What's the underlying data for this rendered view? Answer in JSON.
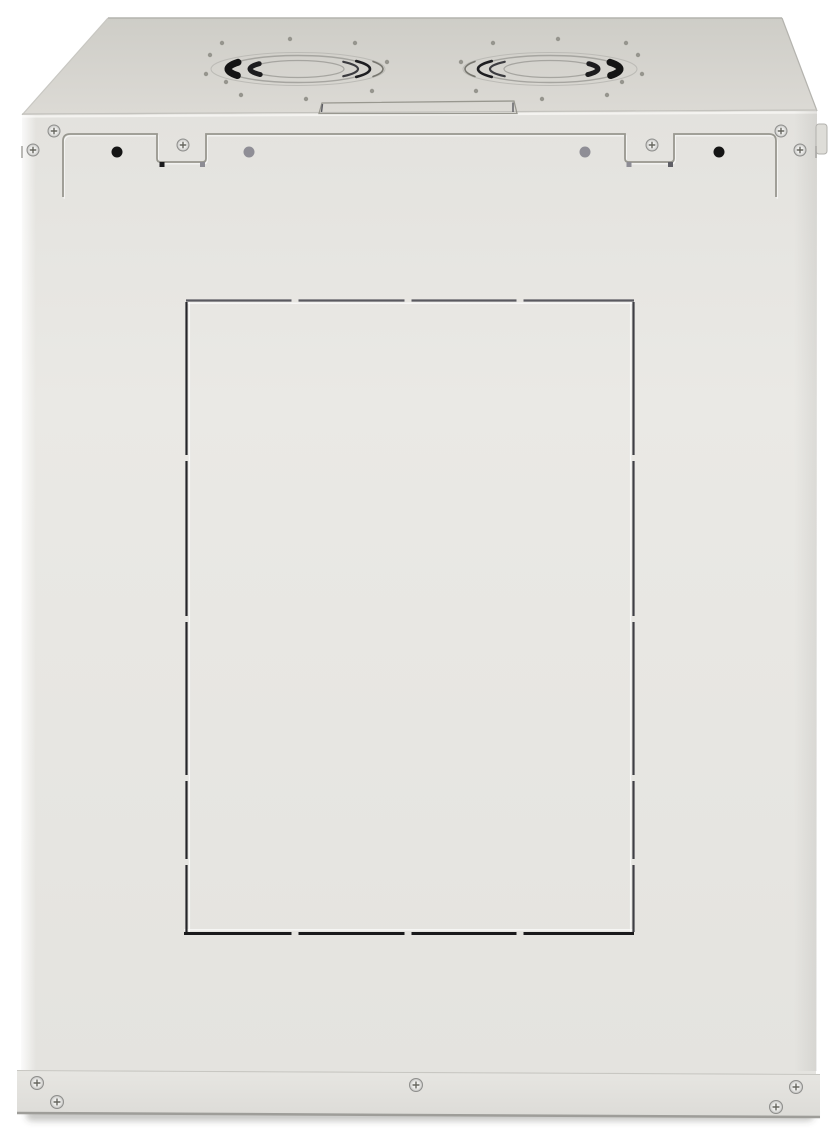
{
  "colors": {
    "background": "#ffffff",
    "top_face_back": "#cecdc7",
    "top_face_front": "#dcdad5",
    "front_face_top": "#e3e2de",
    "front_face_mid": "#eae9e5",
    "front_face_bottom": "#e4e3df",
    "flange_top": "#e7e6e2",
    "flange_bottom": "#dcdbd7",
    "flange_edge": "#9e9d99",
    "edge_line": "#b4b3ae",
    "edge_light": "#c8c7c2",
    "fold_dark": "#c3c2bd",
    "fold_highlight": "#f6f5f2",
    "outline_groove": "#98978f",
    "seam": "#a9a8a4",
    "hole_black": "#151515",
    "hole_gray": "#8f8e96",
    "square_dark": "#1a1a1c",
    "square_gray": "#8d8c94",
    "screw_edge": "#8e8e8c",
    "screw_slot": "#66665f",
    "fan_line": "#a6a5a0",
    "fan_line_light": "#bcbbb6",
    "fan_dark": "#141414",
    "fan_mid": "#3c3c40"
  },
  "layers": [
    {
      "tag": "rect",
      "name": "floor-shadow",
      "attrs": {
        "x": 26,
        "y": 1108,
        "width": 788,
        "height": 13,
        "rx": 6,
        "fill": "rgba(70,70,66,0.30)",
        "filter": "url(#soft)"
      }
    },
    {
      "tag": "polygon",
      "name": "top-panel-face",
      "attrs": {
        "points": "108,18 782,18 817,111 22,115",
        "fill": "url(#gTop)"
      }
    },
    {
      "tag": "polygon",
      "name": "back-panel-face",
      "attrs": {
        "points": "22,115 817,111 816,1074 21,1070",
        "fill": "url(#gFront)"
      }
    },
    {
      "tag": "polygon",
      "name": "bottom-flange",
      "attrs": {
        "points": "17,1070 820,1074 820,1118 17,1114",
        "fill": "url(#gFlange)"
      }
    },
    {
      "tag": "line",
      "name": "top-back-edge",
      "attrs": {
        "x1": 108,
        "y1": 18,
        "x2": 782,
        "y2": 18,
        "stroke": "var(--edge-line)",
        "stroke-width": 1.6
      }
    },
    {
      "tag": "line",
      "name": "top-left-edge",
      "attrs": {
        "x1": 108,
        "y1": 18,
        "x2": 22,
        "y2": 115,
        "stroke": "var(--edge-light)",
        "stroke-width": 1.2
      }
    },
    {
      "tag": "line",
      "name": "top-right-edge",
      "attrs": {
        "x1": 782,
        "y1": 18,
        "x2": 817,
        "y2": 111,
        "stroke": "var(--edge-line)",
        "stroke-width": 1.2
      }
    },
    {
      "tag": "line",
      "name": "top-fold-shade",
      "attrs": {
        "x1": 22,
        "y1": 114,
        "x2": 817,
        "y2": 110,
        "stroke": "var(--fold-dark)",
        "stroke-width": 1.2
      }
    },
    {
      "tag": "line",
      "name": "top-fold-highlight",
      "attrs": {
        "x1": 22,
        "y1": 116.5,
        "x2": 817,
        "y2": 112.5,
        "stroke": "var(--fold-highlight)",
        "stroke-width": 2.2,
        "opacity": 0.9
      }
    },
    {
      "tag": "rect",
      "name": "left-edge-highlight",
      "attrs": {
        "x": 21,
        "y": 115,
        "width": 15,
        "height": 956,
        "fill": "url(#gLeft)"
      }
    },
    {
      "tag": "rect",
      "name": "right-edge-shade",
      "attrs": {
        "x": 794,
        "y": 111,
        "width": 23,
        "height": 960,
        "fill": "url(#gRight)"
      }
    },
    {
      "tag": "rect",
      "name": "hinge-nub",
      "attrs": {
        "x": 816,
        "y": 124,
        "width": 11,
        "height": 30,
        "rx": 3,
        "fill": "#deddd8",
        "stroke": "#b2b1ad",
        "stroke-width": 1
      }
    },
    {
      "tag": "line",
      "name": "left-edge-seam",
      "attrs": {
        "x1": 22,
        "y1": 146,
        "x2": 22,
        "y2": 158,
        "stroke": "var(--seam)",
        "stroke-width": 1.6
      }
    },
    {
      "tag": "line",
      "name": "right-edge-seam",
      "attrs": {
        "x1": 816,
        "y1": 146,
        "x2": 816,
        "y2": 158,
        "stroke": "var(--seam)",
        "stroke-width": 1.6
      }
    },
    {
      "tag": "polygon",
      "name": "cable-entry-cutout",
      "attrs": {
        "points": "322,103 514,101 517,113.5 319,113.5",
        "fill": "none",
        "stroke": "var(--outline-groove)",
        "stroke-width": 1.3
      }
    },
    {
      "tag": "line",
      "name": "cable-entry-tick-left",
      "attrs": {
        "x1": 322.5,
        "y1": 104,
        "x2": 321.5,
        "y2": 112,
        "stroke": "#5a5a60",
        "stroke-width": 1.4
      }
    },
    {
      "tag": "line",
      "name": "cable-entry-tick-right",
      "attrs": {
        "x1": 513,
        "y1": 102.5,
        "x2": 513,
        "y2": 112,
        "stroke": "#5a5a60",
        "stroke-width": 1.4
      }
    },
    {
      "tag": "path",
      "name": "rear-panel-groove-highlight",
      "attrs": {
        "d": "M 63,197 L 63,141 Q 63,134 70,134 L 157,134 L 157,158.5 Q 157,162 160.5,162 L 202.5,162 Q 206,162 206,158.5 L 206,134 L 625,134 L 625,158.5 Q 625,162 628.5,162 L 670.5,162 Q 674,162 674,158.5 L 674,134 L 769,134 Q 776,134 776,141 L 776,197",
        "fill": "none",
        "stroke": "rgba(255,255,255,0.7)",
        "stroke-width": 1.2,
        "transform": "translate(1.2,1.8)"
      }
    },
    {
      "tag": "path",
      "name": "rear-panel-groove",
      "attrs": {
        "d": "M 63,197 L 63,141 Q 63,134 70,134 L 157,134 L 157,158.5 Q 157,162 160.5,162 L 202.5,162 Q 206,162 206,158.5 L 206,134 L 625,134 L 625,158.5 Q 625,162 628.5,162 L 670.5,162 Q 674,162 674,158.5 L 674,134 L 769,134 Q 776,134 776,141 L 776,197",
        "fill": "none",
        "stroke": "var(--outline-groove)",
        "stroke-width": 1.8
      }
    },
    {
      "tag": "line",
      "name": "flange-fold-line",
      "attrs": {
        "x1": 17,
        "y1": 1070.5,
        "x2": 820,
        "y2": 1074.5,
        "stroke": "var(--edge-light)",
        "stroke-width": 1.1
      }
    },
    {
      "tag": "line",
      "name": "flange-bottom-edge",
      "attrs": {
        "x1": 17,
        "y1": 1113,
        "x2": 820,
        "y2": 1117,
        "stroke": "var(--flange-edge)",
        "stroke-width": 2.5
      }
    }
  ],
  "knockout": {
    "top_y": 300.5,
    "bottom_y": 933.5,
    "left_x": 186.5,
    "right_x": 633.5,
    "top_x1": 186,
    "top_x2": 634,
    "bot_x1": 184,
    "bot_x2": 634,
    "side_y1": 302,
    "side_y2": 932,
    "h_gaps": [
      295,
      408,
      520
    ],
    "v_gaps": [
      458,
      619,
      778,
      862
    ],
    "h_gap_w": 7,
    "v_gap_w": 6,
    "stroke_top": "#5a5a60",
    "stroke_bottom": "#19191b",
    "stroke_left": "#26262a",
    "stroke_right": "#3f3f45",
    "w_top": 2.2,
    "w_bottom": 3,
    "w_side": 2.2,
    "hl_color": "rgba(255,255,255,0.75)",
    "hl_w": 1.3,
    "hl_top_y": 303.2,
    "hl_bottom_y": 929.8,
    "hl_left_x": 189.4,
    "hl_right_x": 630.6
  },
  "screws": {
    "top_strip": {
      "r": 6,
      "positions": [
        [
          54,
          131
        ],
        [
          33,
          150
        ],
        [
          183,
          145
        ],
        [
          652,
          145
        ],
        [
          781,
          131
        ],
        [
          800,
          150
        ]
      ]
    },
    "bottom": {
      "r": 6.5,
      "positions": [
        [
          37,
          1083
        ],
        [
          57,
          1102
        ],
        [
          416,
          1085
        ],
        [
          776,
          1107
        ],
        [
          796,
          1087
        ]
      ]
    }
  },
  "holes": {
    "black": {
      "r": 5.5,
      "positions": [
        [
          117,
          152
        ],
        [
          719,
          152
        ]
      ]
    },
    "gray": {
      "r": 5.5,
      "positions": [
        [
          249,
          152
        ],
        [
          585,
          152
        ]
      ]
    }
  },
  "latch_squares": {
    "size": 5,
    "items": [
      {
        "x": 159.5,
        "y": 162,
        "color": "var(--square-dark)"
      },
      {
        "x": 200,
        "y": 162,
        "color": "var(--square-gray)"
      },
      {
        "x": 626.5,
        "y": 162,
        "color": "var(--square-gray)"
      },
      {
        "x": 668,
        "y": 162,
        "color": "#5f5f66"
      }
    ]
  },
  "fans": {
    "centers": [
      [
        298,
        69
      ],
      [
        550,
        69
      ]
    ],
    "mirror": [
      1,
      -1
    ],
    "rings": [
      {
        "rx": 87,
        "ry": 16.5,
        "w": 1,
        "color": "var(--fan-line-light)"
      },
      {
        "rx": 71,
        "ry": 13.5,
        "w": 1.4,
        "color": "var(--fan-line)"
      },
      {
        "rx": 46,
        "ry": 8.5,
        "w": 1.2,
        "color": "var(--fan-line)"
      }
    ],
    "bold_arcs": [
      {
        "rx": 70,
        "ry": 13,
        "a1": 150,
        "a2": 211,
        "w": 7,
        "color": "var(--fan-dark)"
      },
      {
        "rx": 48,
        "ry": 9,
        "a1": 142,
        "a2": 216,
        "w": 5,
        "color": "#1c1c1e"
      }
    ],
    "thin_arcs": [
      {
        "rx": 72,
        "ry": 13.5,
        "a1": -36,
        "a2": 36,
        "w": 2.6,
        "color": "#1e1e21"
      },
      {
        "rx": 60,
        "ry": 11,
        "a1": -41,
        "a2": 41,
        "w": 2.2,
        "color": "var(--fan-mid)"
      },
      {
        "rx": 85,
        "ry": 16,
        "a1": -28,
        "a2": 28,
        "w": 1.6,
        "color": "#77766f"
      }
    ],
    "hole_offsets": [
      [
        -88,
        -14
      ],
      [
        -76,
        -26
      ],
      [
        -92,
        5
      ],
      [
        -72,
        13
      ],
      [
        -57,
        26
      ],
      [
        -8,
        -30
      ],
      [
        8,
        30
      ],
      [
        57,
        -26
      ],
      [
        74,
        22
      ],
      [
        89,
        -7
      ]
    ],
    "hole_r": 2.2,
    "hole_color": "#96958e"
  }
}
